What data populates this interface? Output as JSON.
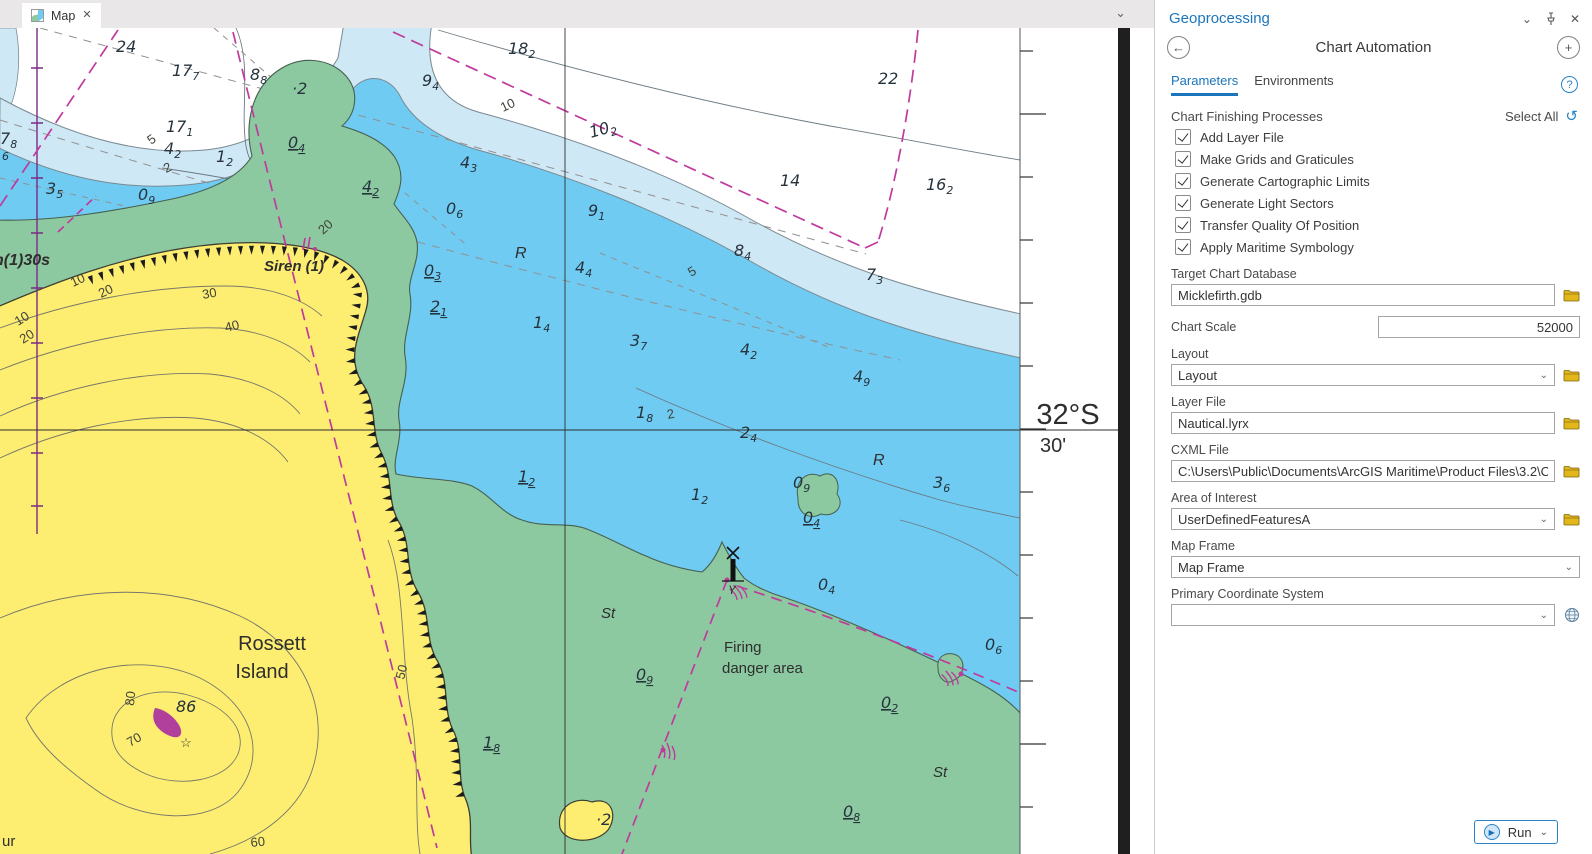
{
  "window": {
    "tab_label": "Map"
  },
  "colors": {
    "accent_blue": "#1b75bc",
    "land_yellow": "#fdee72",
    "intertidal_green": "#8cc9a0",
    "shallow_blue": "#6fcbf2",
    "mid_blue": "#cfe8f5",
    "magenta": "#c03a9e",
    "folder_gold": "#e3b71c"
  },
  "panel": {
    "title": "Geoprocessing",
    "tool_title": "Chart Automation",
    "tabs": {
      "parameters": "Parameters",
      "environments": "Environments"
    },
    "help_glyph": "?",
    "processes_label": "Chart Finishing Processes",
    "select_all_label": "Select All",
    "processes": [
      {
        "label": "Add Layer File",
        "checked": true
      },
      {
        "label": "Make Grids and Graticules",
        "checked": true
      },
      {
        "label": "Generate Cartographic Limits",
        "checked": true
      },
      {
        "label": "Generate Light Sectors",
        "checked": true
      },
      {
        "label": "Transfer Quality Of Position",
        "checked": true
      },
      {
        "label": "Apply Maritime Symbology",
        "checked": true
      }
    ],
    "fields": {
      "target_db": {
        "label": "Target Chart Database",
        "value": "Micklefirth.gdb"
      },
      "chart_scale": {
        "label": "Chart Scale",
        "value": "52000"
      },
      "layout": {
        "label": "Layout",
        "value": "Layout"
      },
      "layer_file": {
        "label": "Layer File",
        "value": "Nautical.lyrx"
      },
      "cxml": {
        "label": "CXML File",
        "value": "C:\\Users\\Public\\Documents\\ArcGIS Maritime\\Product Files\\3.2\\Chartin"
      },
      "aoi": {
        "label": "Area of Interest",
        "value": "UserDefinedFeaturesA"
      },
      "map_frame": {
        "label": "Map Frame",
        "value": "Map Frame"
      },
      "pcs": {
        "label": "Primary Coordinate System",
        "value": ""
      }
    },
    "run_label": "Run"
  },
  "map": {
    "margin": {
      "lat": "32°S",
      "minutes": "30'"
    },
    "soundings": [
      {
        "x": 116,
        "y": 24,
        "m": "24"
      },
      {
        "x": 172,
        "y": 48,
        "m": "17",
        "s": "7"
      },
      {
        "x": 250,
        "y": 52,
        "m": "8",
        "s": "8"
      },
      {
        "x": 292,
        "y": 66,
        "m": "2",
        "dot": 1
      },
      {
        "x": 422,
        "y": 58,
        "m": "9",
        "s": "4"
      },
      {
        "x": 508,
        "y": 26,
        "m": "18",
        "s": "2"
      },
      {
        "x": 878,
        "y": 56,
        "m": "22"
      },
      {
        "x": 166,
        "y": 104,
        "m": "17",
        "s": "1"
      },
      {
        "x": 0,
        "y": 116,
        "m": "7",
        "s": "8"
      },
      {
        "x": 591,
        "y": 110,
        "m": "10",
        "s": "2",
        "r": -16
      },
      {
        "x": 780,
        "y": 158,
        "m": "14"
      },
      {
        "x": 926,
        "y": 162,
        "m": "16",
        "s": "2"
      },
      {
        "x": 46,
        "y": 166,
        "m": "3",
        "s": "5"
      },
      {
        "x": 164,
        "y": 126,
        "m": "4",
        "s": "2"
      },
      {
        "x": 216,
        "y": 134,
        "m": "1",
        "s": "2"
      },
      {
        "x": 138,
        "y": 172,
        "m": "0",
        "s": "9"
      },
      {
        "x": 288,
        "y": 120,
        "m": "0",
        "s": "4",
        "u": 1
      },
      {
        "x": 362,
        "y": 164,
        "m": "4",
        "s": "2",
        "u": 1
      },
      {
        "x": 460,
        "y": 140,
        "m": "4",
        "s": "3"
      },
      {
        "x": 446,
        "y": 186,
        "m": "0",
        "s": "6"
      },
      {
        "x": 588,
        "y": 188,
        "m": "9",
        "s": "1"
      },
      {
        "x": 734,
        "y": 228,
        "m": "8",
        "s": "4"
      },
      {
        "x": 866,
        "y": 252,
        "m": "7",
        "s": "3"
      },
      {
        "x": 424,
        "y": 248,
        "m": "0",
        "s": "3",
        "u": 1
      },
      {
        "x": 575,
        "y": 245,
        "m": "4",
        "s": "4"
      },
      {
        "x": 533,
        "y": 300,
        "m": "1",
        "s": "4"
      },
      {
        "x": 430,
        "y": 284,
        "m": "2",
        "s": "1",
        "u": 1
      },
      {
        "x": 630,
        "y": 318,
        "m": "3",
        "s": "7"
      },
      {
        "x": 740,
        "y": 327,
        "m": "4",
        "s": "2"
      },
      {
        "x": 853,
        "y": 354,
        "m": "4",
        "s": "9"
      },
      {
        "x": 636,
        "y": 390,
        "m": "1",
        "s": "8"
      },
      {
        "x": 740,
        "y": 410,
        "m": "2",
        "s": "4"
      },
      {
        "x": 933,
        "y": 460,
        "m": "3",
        "s": "6"
      },
      {
        "x": 518,
        "y": 454,
        "m": "1",
        "s": "2",
        "u": 1
      },
      {
        "x": 691,
        "y": 472,
        "m": "1",
        "s": "2"
      },
      {
        "x": 793,
        "y": 460,
        "m": "0",
        "s": "9"
      },
      {
        "x": 803,
        "y": 495,
        "m": "0",
        "s": "4",
        "u": 1
      },
      {
        "x": 818,
        "y": 562,
        "m": "0",
        "s": "4"
      },
      {
        "x": 985,
        "y": 622,
        "m": "0",
        "s": "6"
      },
      {
        "x": 636,
        "y": 652,
        "m": "0",
        "s": "9",
        "u": 1
      },
      {
        "x": 881,
        "y": 680,
        "m": "0",
        "s": "2",
        "u": 1
      },
      {
        "x": 843,
        "y": 789,
        "m": "0",
        "s": "8",
        "u": 1
      },
      {
        "x": 483,
        "y": 720,
        "m": "1",
        "s": "8",
        "u": 1
      },
      {
        "x": 176,
        "y": 684,
        "m": "86"
      },
      {
        "x": 596,
        "y": 797,
        "m": "2",
        "dot": 1
      },
      {
        "x": 2,
        "y": 128,
        "m": "",
        "s": "6"
      }
    ],
    "contour_labels": [
      {
        "t": "10",
        "x": 503,
        "y": 84,
        "r": -25
      },
      {
        "t": "5",
        "x": 151,
        "y": 117,
        "r": -35
      },
      {
        "t": "2",
        "x": 166,
        "y": 145,
        "r": -25
      },
      {
        "t": "5",
        "x": 691,
        "y": 249,
        "r": -30
      },
      {
        "t": "2",
        "x": 668,
        "y": 391,
        "r": -12
      },
      {
        "t": "20",
        "x": 323,
        "y": 207,
        "r": -42
      },
      {
        "t": "10",
        "x": 73,
        "y": 259,
        "r": -25
      },
      {
        "t": "20",
        "x": 101,
        "y": 270,
        "r": -25
      },
      {
        "t": "10",
        "x": 18,
        "y": 298,
        "r": -32
      },
      {
        "t": "20",
        "x": 23,
        "y": 316,
        "r": -32
      },
      {
        "t": "30",
        "x": 203,
        "y": 271,
        "r": -10
      },
      {
        "t": "40",
        "x": 226,
        "y": 304,
        "r": -14
      },
      {
        "t": "50",
        "x": 404,
        "y": 652,
        "r": -76
      },
      {
        "t": "60",
        "x": 251,
        "y": 819,
        "r": -6
      },
      {
        "t": "70",
        "x": 130,
        "y": 719,
        "r": -30
      },
      {
        "t": "80",
        "x": 134,
        "y": 678,
        "r": -85
      }
    ],
    "place_labels": [
      {
        "t": "R",
        "x": 515,
        "y": 230,
        "i": 1,
        "fs": 16
      },
      {
        "t": "R",
        "x": 873,
        "y": 437,
        "i": 1,
        "fs": 16
      },
      {
        "t": "St",
        "x": 601,
        "y": 590,
        "i": 1,
        "fs": 15
      },
      {
        "t": "St",
        "x": 933,
        "y": 749,
        "i": 1,
        "fs": 15
      },
      {
        "t": "Y",
        "x": 728,
        "y": 566,
        "i": 1,
        "fs": 12
      },
      {
        "t": "Siren (1)",
        "x": 264,
        "y": 243,
        "i": 1,
        "b": 1,
        "fs": 15
      },
      {
        "t": "n(1)30s",
        "x": -6,
        "y": 237,
        "i": 1,
        "b": 1,
        "fs": 16
      },
      {
        "t": "Rossett",
        "x": 272,
        "y": 622,
        "fs": 20,
        "a": "middle"
      },
      {
        "t": "Island",
        "x": 262,
        "y": 650,
        "fs": 20,
        "a": "middle"
      },
      {
        "t": "Firing",
        "x": 724,
        "y": 624,
        "fs": 15
      },
      {
        "t": "danger area",
        "x": 722,
        "y": 645,
        "fs": 15
      },
      {
        "t": "ur",
        "x": 2,
        "y": 818,
        "fs": 15
      },
      {
        "t": "☆",
        "x": 186,
        "y": 719,
        "fs": 13,
        "a": "middle"
      },
      {
        "t": "32°S",
        "x": 1068,
        "y": 396,
        "fs": 29,
        "a": "middle"
      },
      {
        "t": "30'",
        "x": 1053,
        "y": 424,
        "fs": 20,
        "a": "middle"
      }
    ]
  }
}
